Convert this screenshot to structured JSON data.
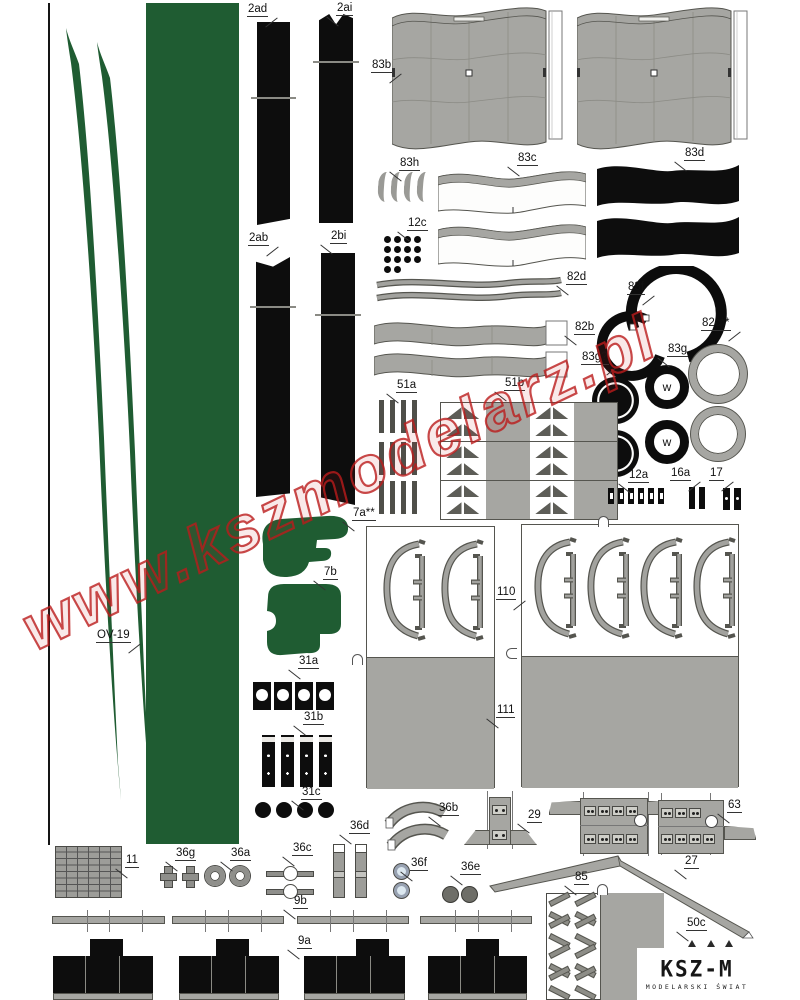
{
  "watermark": "www.kszmodelarz.pl",
  "logo": {
    "title": "KSZ-M",
    "subtitle": "MODELARSKI ŚWIAT"
  },
  "wheel_letter": "w",
  "colors": {
    "green": "#1f5c32",
    "black": "#0d0d0d",
    "gray": "#a6a6a2",
    "watermark_red": "#ba1c1c"
  },
  "labels": {
    "p2ad": "2ad",
    "p2ai": "2ai",
    "p2ab": "2ab",
    "p2bi": "2bi",
    "p83b": "83b",
    "p83h": "83h",
    "p83c": "83c",
    "p83d": "83d",
    "p12c": "12c",
    "p82d": "82d",
    "p82b": "82b",
    "p83f": "83f",
    "p82c": "82c**",
    "p83g": "83g",
    "p83gq": "83g?",
    "p51a": "51a",
    "p51b": "51b",
    "p7a": "7a**",
    "p7b": "7b",
    "pov19": "OV-19",
    "p110": "110",
    "p111": "111",
    "p31a": "31a",
    "p31b": "31b",
    "p31c": "31c",
    "p12a": "12a",
    "p16a": "16a",
    "p17": "17",
    "p36b": "36b",
    "p29": "29",
    "p63": "63",
    "p36d": "36d",
    "p36c": "36c",
    "p36g": "36g",
    "p36a": "36a",
    "p36f": "36f",
    "p36e": "36e",
    "p27": "27",
    "p85": "85",
    "p50c": "50c",
    "p11": "11",
    "p9b": "9b",
    "p9a": "9a"
  }
}
